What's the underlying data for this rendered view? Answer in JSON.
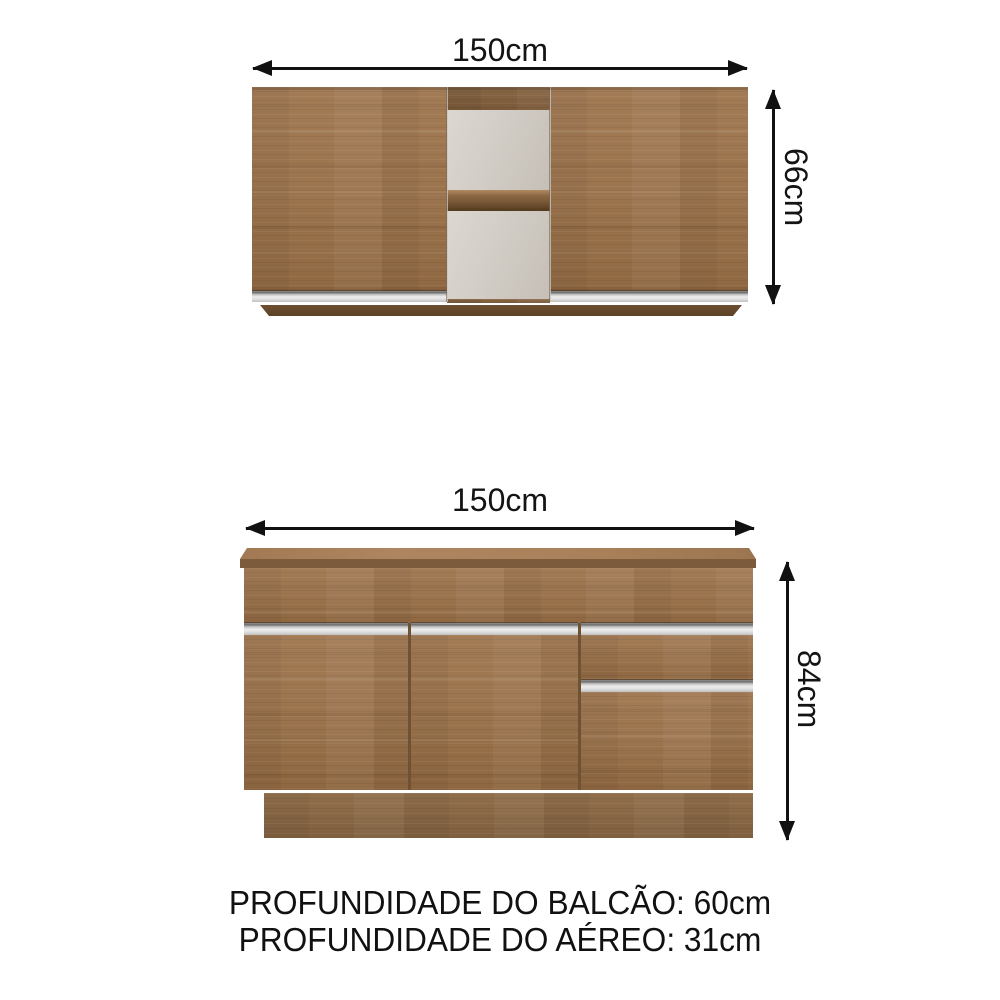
{
  "upper_cabinet": {
    "name": "armario aereo",
    "width_label": "150cm",
    "height_label": "66cm",
    "doors": 2,
    "open_shelves": 2
  },
  "lower_cabinet": {
    "name": "balcao",
    "width_label": "150cm",
    "height_label": "84cm",
    "doors": 3,
    "drawers": 1
  },
  "footer": {
    "line1": "PROFUNDIDADE DO BALCÃO: 60cm",
    "line2": "PROFUNDIDADE DO AÉREO: 31cm"
  },
  "colors": {
    "background": "#ffffff",
    "wood": "#9c744e",
    "wood_dark": "#7e5d3d",
    "plinth": "#8a6a4a",
    "countertop_edge": "#7b5b3b",
    "countertop_surface": "#a9825b",
    "niche_interior": "#d5d0c9",
    "handle_silver": "#e2e2e2",
    "arrow": "#111111",
    "text": "#141414"
  }
}
